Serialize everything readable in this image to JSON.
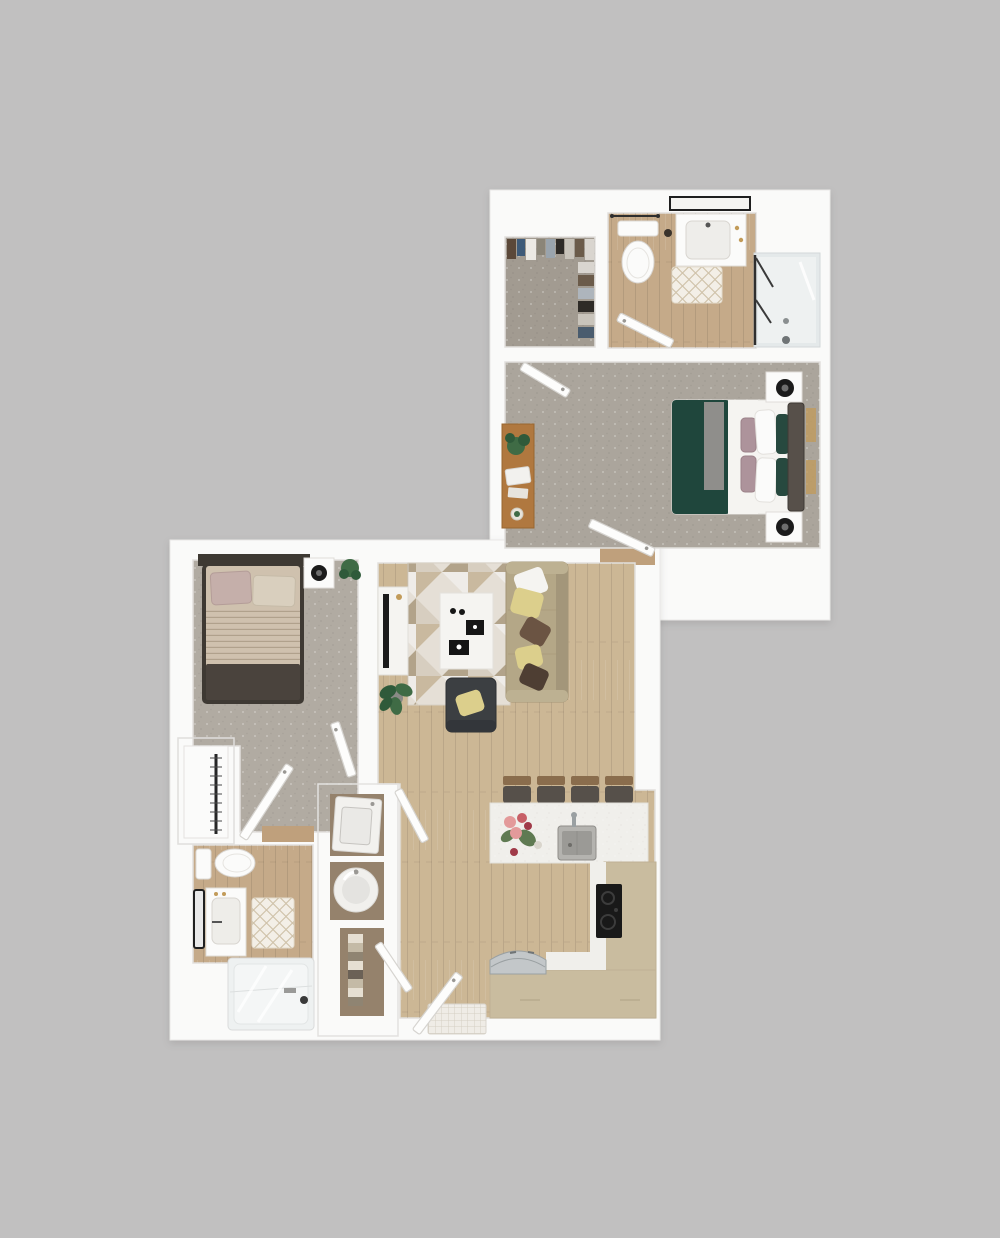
{
  "meta": {
    "description": "3D top-down rendered floor plan of a one-bedroom apartment shown as two connected white plan blocks on a plain gray background; upper block contains walk-in closet, bathroom with shower, and carpeted bedroom; lower block contains a second bedroom, bathroom with tub, stacked laundry closet, living room, kitchen with island and entry",
    "text_labels": []
  },
  "canvas": {
    "width": 1000,
    "height": 1238
  },
  "colors": {
    "bg": "#c1c0c0",
    "plan": "#fafaf9",
    "planEdge": "#ebeae8",
    "wallShadow": "#e2e0dd",
    "carpetA": "#aba59c",
    "carpetCloset": "#a29b91",
    "carpetB": "#b1aba2",
    "woodLiving": "#ccb795",
    "woodBath": "#c5aa89",
    "woodNiche": "#95826c",
    "woodThresh": "#bfa07c",
    "white": "#f5f4f1",
    "whiteBright": "#fbfbfa",
    "steel": "#c3c7c9",
    "steelDark": "#9aa0a2",
    "sinkSteel": "#b4b3af",
    "sinkInner": "#9b9a96",
    "black": "#1b1b1b",
    "charcoal": "#3c3f42",
    "stoveBlack": "#191919",
    "bedGreen": "#1f463c",
    "bedGreenDark": "#27493f",
    "throwGray": "#8f8e8b",
    "headboard": "#57504a",
    "mauve": "#ad939b",
    "gold": "#c29b59",
    "duvetB": "#cfc1ae",
    "pillowMauve": "#c5afaa",
    "pillowBeige": "#d9cfbe",
    "bedFootB": "#4a433d",
    "bedFrameB": "#3e3933",
    "sofa": "#b4a787",
    "sofaDark": "#a3967a",
    "sofaArm": "#bdb192",
    "cushionYellow": "#dccf8c",
    "cushionBrown": "#6b5443",
    "cushionDarkBrown": "#4e3e33",
    "cabinetTan": "#c9bc9f",
    "counterWhite": "#f0efeb",
    "glass": "#e4e9ea",
    "glassPan": "#eef1f1",
    "plantGreen": "#3f6b45",
    "plantDark": "#2f5a3a",
    "deskWood": "#b0783f",
    "matBase": "#efece6",
    "frameBlack": "#222222",
    "doorWhite": "#fdfdfc",
    "doorEdge": "#d6d4d0",
    "flowerPink": "#e39a9a",
    "flowerRed": "#c75f66",
    "flowerDeep": "#a03a48",
    "leafGreen": "#5f7a52",
    "towelA": "#e6dfd2",
    "towelB": "#c4baa6",
    "towelC": "#8f8472",
    "towelD": "#6b6156"
  },
  "units": [
    {
      "id": "upper-unit",
      "rooms": [
        {
          "name": "walk-in-closet",
          "flooring": "carpet",
          "contents": [
            "hanging-clothes"
          ]
        },
        {
          "name": "bathroom",
          "flooring": "wood-tile",
          "contents": [
            "toilet",
            "towel-bar",
            "vanity-sink",
            "mirror",
            "bath-mat",
            "glass-shower"
          ]
        },
        {
          "name": "bedroom",
          "flooring": "carpet",
          "contents": [
            "queen-bed-green",
            "nightstand-top",
            "nightstand-bottom",
            "table-lamp-top",
            "table-lamp-bottom",
            "desk",
            "desk-plant",
            "door-to-hall",
            "door-to-stair"
          ]
        }
      ]
    },
    {
      "id": "lower-unit",
      "rooms": [
        {
          "name": "bedroom",
          "flooring": "carpet",
          "contents": [
            "queen-bed-beige",
            "nightstand",
            "table-lamp",
            "plant",
            "reach-in-closet",
            "door",
            "door-secondary"
          ]
        },
        {
          "name": "bathroom",
          "flooring": "wood-tile",
          "contents": [
            "toilet",
            "vanity-sink",
            "mirror",
            "bath-mat",
            "tub-shower"
          ]
        },
        {
          "name": "laundry-closet",
          "contents": [
            "dryer",
            "washer",
            "linen-shelves",
            "closet-doors"
          ]
        },
        {
          "name": "living-room",
          "flooring": "wood",
          "contents": [
            "area-rug",
            "tv-console",
            "tv",
            "coffee-table",
            "sofa",
            "armchair",
            "floor-plant"
          ]
        },
        {
          "name": "kitchen",
          "flooring": "wood",
          "contents": [
            "island",
            "island-sink",
            "flower-vase",
            "bar-stool-1",
            "bar-stool-2",
            "bar-stool-3",
            "bar-stool-4",
            "cooktop",
            "l-counter",
            "refrigerator"
          ]
        },
        {
          "name": "entry",
          "contents": [
            "entry-door",
            "door-mat"
          ]
        }
      ]
    }
  ]
}
